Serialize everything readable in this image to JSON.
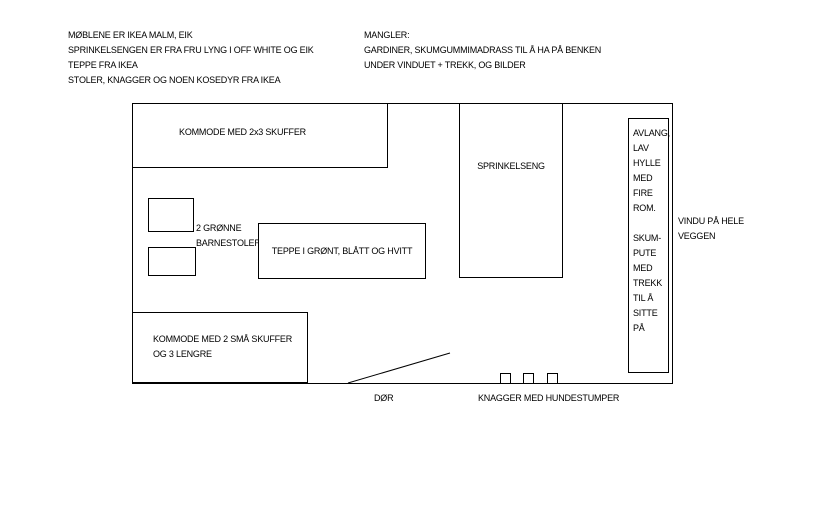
{
  "colors": {
    "background": "#ffffff",
    "ink": "#000000"
  },
  "notes_left": {
    "lines": [
      "MØBLENE ER IKEA MALM, EIK",
      "SPRINKELSENGEN ER FRA FRU LYNG I OFF WHITE OG EIK",
      "TEPPE FRA IKEA",
      "STOLER, KNAGGER OG NOEN KOSEDYR FRA IKEA"
    ]
  },
  "notes_right": {
    "lines": [
      "MANGLER:",
      "GARDINER, SKUMGUMMIMADRASS TIL Å HA PÅ BENKEN",
      "UNDER VINDUET + TREKK, OG BILDER"
    ]
  },
  "floorplan": {
    "dresser_large": {
      "label": "KOMMODE MED 2x3 SKUFFER"
    },
    "crib": {
      "label": "SPRINKELSENG"
    },
    "chairs_label": {
      "lines": [
        "2 GRØNNE",
        "BARNESTOLER"
      ]
    },
    "rug": {
      "label": "TEPPE I GRØNT, BLÅTT OG HVITT"
    },
    "dresser_small": {
      "lines": [
        "KOMMODE MED 2 SMÅ SKUFFER",
        "OG 3 LENGRE"
      ]
    },
    "shelf_bench": {
      "lines": [
        "AVLANG,",
        "LAV",
        "HYLLE",
        "MED",
        "FIRE",
        "ROM.",
        "",
        "SKUM-",
        "PUTE",
        "MED",
        "TREKK",
        "TIL Å",
        "SITTE",
        "PÅ"
      ]
    },
    "window_note": {
      "lines": [
        "VINDU PÅ HELE",
        "VEGGEN"
      ]
    },
    "door": {
      "label": "DØR"
    },
    "hooks": {
      "label": "KNAGGER MED HUNDESTUMPER"
    }
  }
}
